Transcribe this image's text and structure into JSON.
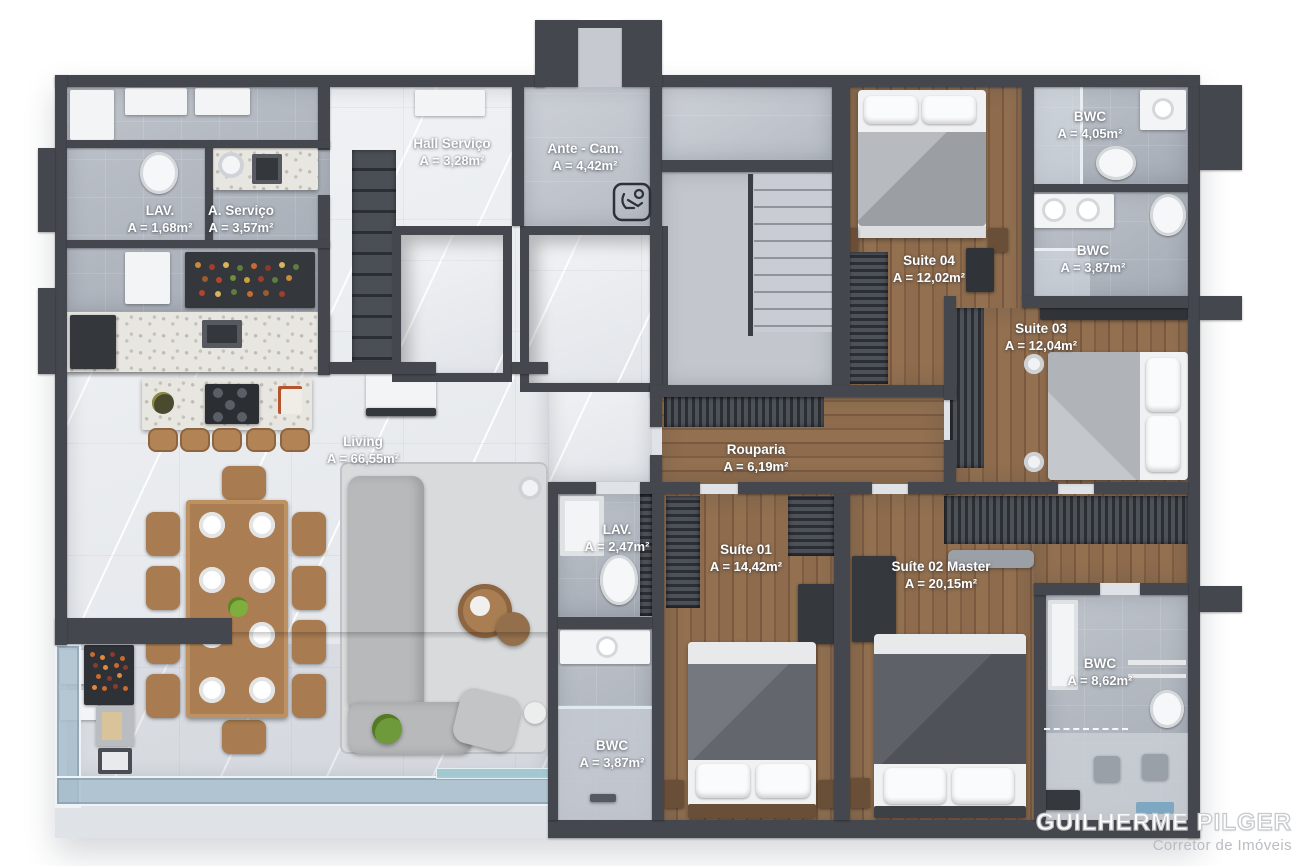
{
  "rooms": [
    {
      "name": "Hall Serviço",
      "area": "A = 3,28m²"
    },
    {
      "name": "Ante - Cam.",
      "area": "A = 4,42m²"
    },
    {
      "name": "LAV.",
      "area": "A = 1,68m²"
    },
    {
      "name": "A. Serviço",
      "area": "A = 3,57m²"
    },
    {
      "name": "BWC",
      "area": "A = 4,05m²"
    },
    {
      "name": "BWC",
      "area": "A = 3,87m²"
    },
    {
      "name": "Suite 04",
      "area": "A = 12,02m²"
    },
    {
      "name": "Suite 03",
      "area": "A = 12,04m²"
    },
    {
      "name": "Living",
      "area": "A = 66,55m²"
    },
    {
      "name": "Rouparia",
      "area": "A = 6,19m²"
    },
    {
      "name": "LAV.",
      "area": "A = 2,47m²"
    },
    {
      "name": "Suíte 01",
      "area": "A = 14,42m²"
    },
    {
      "name": "Suíte 02 Master",
      "area": "A = 20,15m²"
    },
    {
      "name": "BWC",
      "area": "A = 8,62m²"
    },
    {
      "name": "BWC",
      "area": "A = 3,87m²"
    }
  ],
  "watermark": {
    "title": "GUILHERME PILGER",
    "subtitle": "Corretor de Imóveis"
  },
  "icons": {
    "ante_cam": "accessibility"
  },
  "palette": {
    "wall": "#44484e",
    "marble": "#eceef0",
    "tile": "#b2b7bf",
    "wood": "#86654a",
    "glass": "#aabfcc",
    "label_text": "#ffffff"
  }
}
